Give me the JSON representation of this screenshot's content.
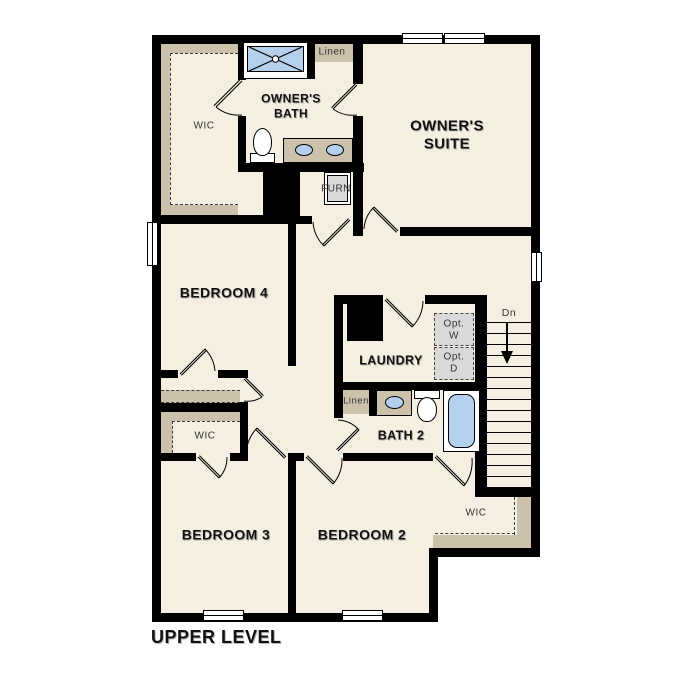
{
  "plan": {
    "level_label": "UPPER LEVEL",
    "rooms": {
      "wic_top": "WIC",
      "owners_bath": "OWNER'S BATH",
      "linen_top": "Linen",
      "owners_suite": "OWNER'S SUITE",
      "furnace": "FURN",
      "bedroom4": "BEDROOM 4",
      "laundry": "LAUNDRY",
      "opt_washer": "Opt. W",
      "opt_dryer": "Opt. D",
      "stairs_dn": "Dn",
      "linen_bath": "Linen",
      "bath2": "BATH 2",
      "wic_left": "WIC",
      "bedroom3": "BEDROOM 3",
      "bedroom2": "BEDROOM 2",
      "wic_bottom": "WIC"
    },
    "colors": {
      "floor": "#f5efe2",
      "wall": "#000000",
      "casework": "#ccc2ab",
      "fixture_blue": "#b4d0ec",
      "appliance_gray": "#d9d9d9",
      "label": "#111111",
      "small_label": "#333333"
    }
  }
}
